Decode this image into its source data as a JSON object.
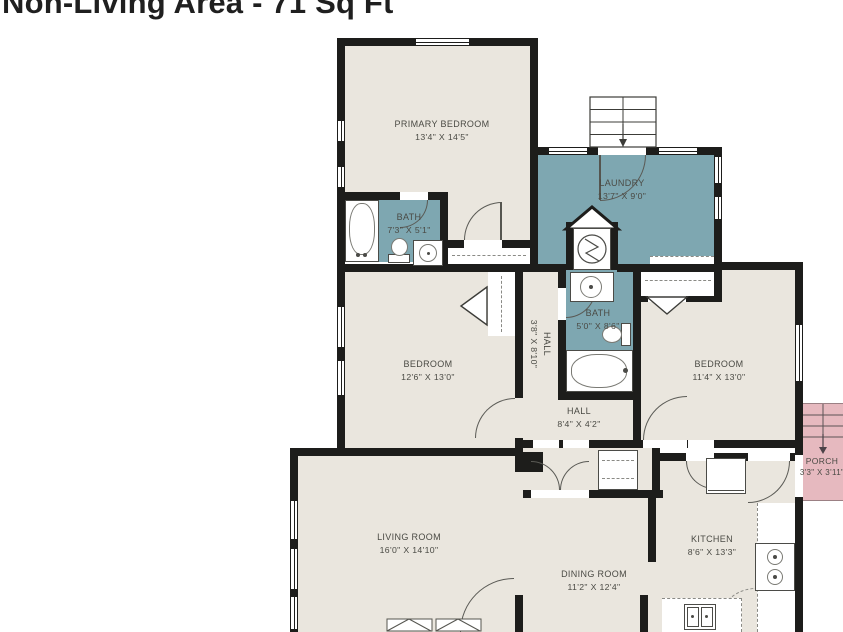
{
  "title": "Non-Living Area - 71 Sq Ft",
  "colors": {
    "floor": "#eae6de",
    "wet_room": "#7ea7b1",
    "porch": "#e6b9bf",
    "wall": "#1d1d1b",
    "label_text": "#4a4a44"
  },
  "rooms": [
    {
      "id": "primary-bedroom",
      "name": "PRIMARY BEDROOM",
      "dims": "13'4\" X 14'5\""
    },
    {
      "id": "laundry",
      "name": "LAUNDRY",
      "dims": "13'7\" X 9'0\""
    },
    {
      "id": "bath-primary",
      "name": "BATH",
      "dims": "7'3\" X 5'1\""
    },
    {
      "id": "bedroom-left",
      "name": "BEDROOM",
      "dims": "12'6\" X 13'0\""
    },
    {
      "id": "hall-upper",
      "name": "HALL",
      "dims": "3'8\" X 8'10\""
    },
    {
      "id": "bath-hall",
      "name": "BATH",
      "dims": "5'0\" X 8'6\""
    },
    {
      "id": "bedroom-right",
      "name": "BEDROOM",
      "dims": "11'4\" X 13'0\""
    },
    {
      "id": "hall-lower",
      "name": "HALL",
      "dims": "8'4\" X 4'2\""
    },
    {
      "id": "porch",
      "name": "PORCH",
      "dims": "3'3\" X 3'11\""
    },
    {
      "id": "living-room",
      "name": "LIVING ROOM",
      "dims": "16'0\" X 14'10\""
    },
    {
      "id": "dining-room",
      "name": "DINING ROOM",
      "dims": "11'2\" X 12'4\""
    },
    {
      "id": "kitchen",
      "name": "KITCHEN",
      "dims": "8'6\" X 13'3\""
    }
  ]
}
